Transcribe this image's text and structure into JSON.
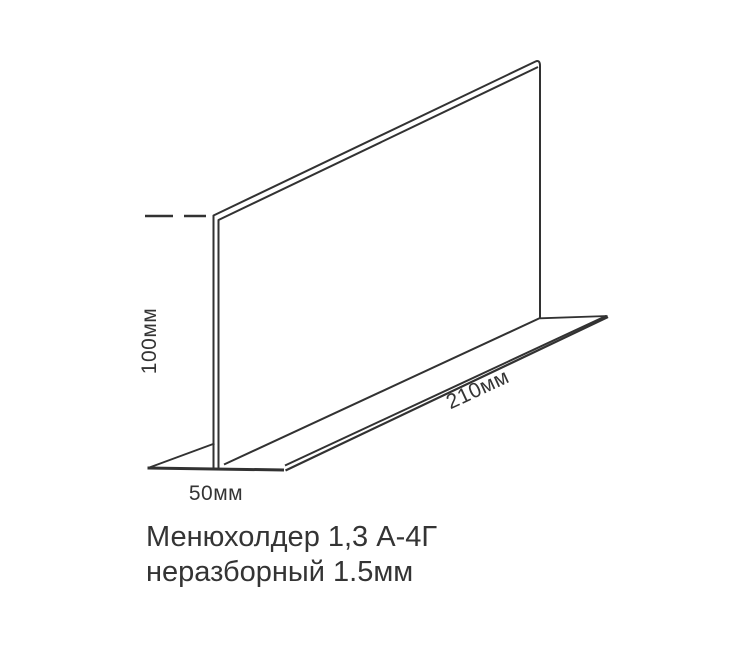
{
  "drawing": {
    "dimensions": {
      "height": "100мм",
      "length": "210мм",
      "width": "50мм"
    },
    "caption": {
      "line1": "Менюхолдер 1,3 А-4Г",
      "line2": "неразборный 1.5мм"
    },
    "colors": {
      "line": "#323232",
      "background": "#ffffff"
    }
  }
}
